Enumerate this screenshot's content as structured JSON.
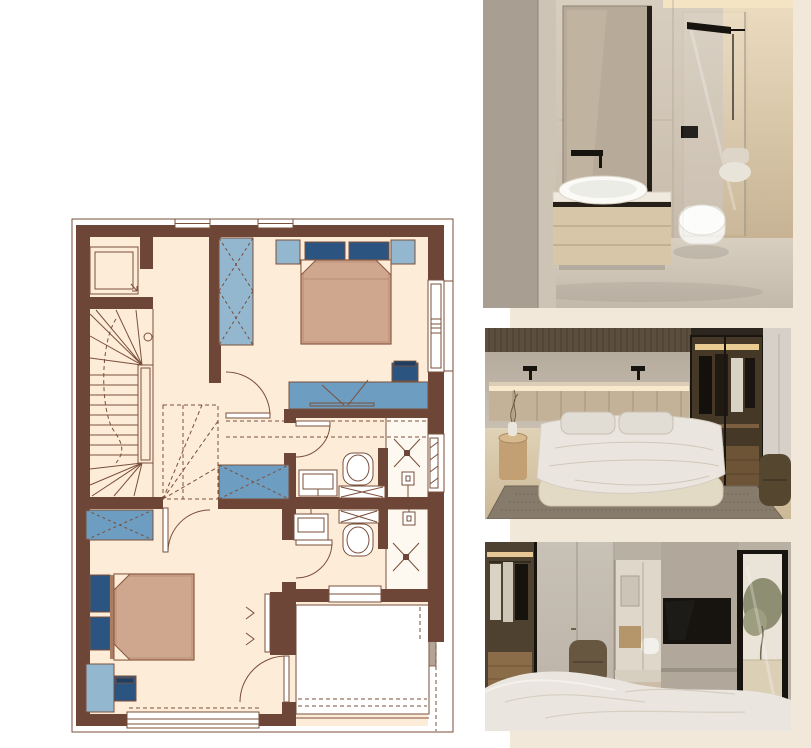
{
  "palette": {
    "page-bg": "#ffffff",
    "panel-bg": "#f2e8da",
    "plan-wall": "#6d4637",
    "plan-line": "#7a4f3b",
    "plan-floor": "#fdecd8",
    "plan-light-blue": "#92b7ce",
    "plan-mid-blue": "#6d9ec2",
    "plan-navy": "#2b5580",
    "plan-bed-tan": "#cfa78f",
    "plan-bed-line": "#8a5a42",
    "plan-white": "#ffffff",
    "photo-dark": "#17130f",
    "photo-linen": "#eae6df",
    "photo-wood": "#d8c6a9",
    "photo-olive": "#8e8e72"
  },
  "floor_plan": {
    "type": "architectural-upper-floor-plan",
    "description": "Upper floor plan with winder staircase, elevator, two bedrooms, two en-suite bathrooms, hall and terrace",
    "rooms": [
      {
        "name": "stair-hall",
        "features": [
          "elevator",
          "winder-staircase",
          "wardrobe"
        ]
      },
      {
        "name": "bedroom-top-right",
        "features": [
          "double-bed",
          "two-nightstands",
          "tall-wardrobe",
          "desk-with-chair",
          "side-window"
        ]
      },
      {
        "name": "bathroom-upper",
        "features": [
          "washbasin",
          "toilet",
          "walk-in-shower",
          "radiator-window"
        ]
      },
      {
        "name": "bathroom-lower",
        "features": [
          "washbasin",
          "toilet",
          "walk-in-shower"
        ]
      },
      {
        "name": "bedroom-bottom-left",
        "features": [
          "double-bed",
          "desk-with-chair",
          "low-wardrobe",
          "wall-tv",
          "large-bottom-window",
          "terrace-door"
        ]
      },
      {
        "name": "terrace",
        "features": [
          "open-deck",
          "glazed-edge"
        ]
      }
    ]
  },
  "photos": [
    {
      "name": "bathroom-render",
      "description": "Beige bathroom with wooden floating vanity, white vessel sink, black wall tap, wall-hung toilet and glass walk-in shower"
    },
    {
      "name": "bedroom-render",
      "description": "Bedroom with upholstered bed, backlit headboard, black sconces, bronze glass wardrobe, wooden side table and brown armchair on a woven rug"
    },
    {
      "name": "bedroom-tv-render",
      "description": "Bedroom with walk-in wardrobe, light wardrobe doors, wall-mounted TV, en-suite bathroom glimpse and glass door to terrace with olive tree"
    }
  ]
}
